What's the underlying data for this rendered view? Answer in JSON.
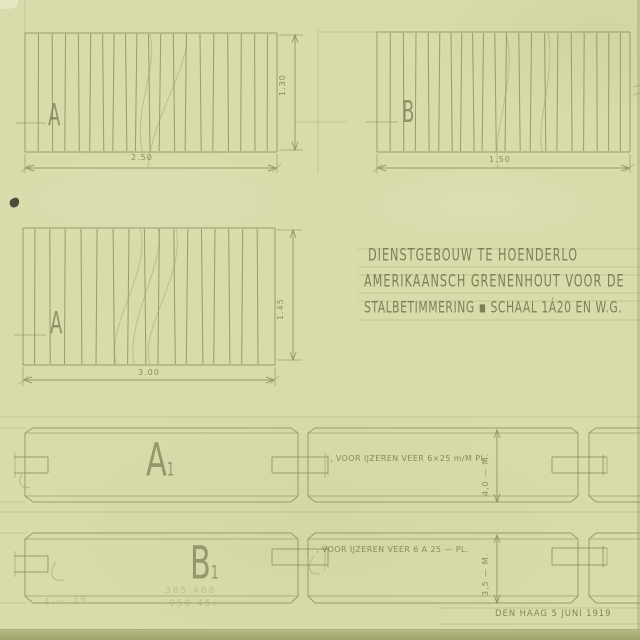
{
  "title_block": {
    "line1": "DIENSTGEBOUW TE HOENDERLO",
    "line2": "AMERIKAANSCH GRENENHOUT VOOR DE",
    "line3": "STALBETIMMERING ▪ SCHAAL 1Á20 EN W.G."
  },
  "panels": {
    "top_left": {
      "label": "A",
      "width_dim": "2.50",
      "height_dim": "1.30",
      "slat_count": 19
    },
    "top_right": {
      "label": "B",
      "width_dim": "1.50",
      "slat_count": 20
    },
    "mid_left": {
      "label": "A",
      "width_dim": "3.00",
      "height_dim": "1.45",
      "slat_count": 16
    }
  },
  "plank_rows": {
    "row_a": {
      "label": "A",
      "index": "1",
      "note": ", VOOR IJZEREN VEER 6×25 m/M PL.",
      "thickness_dim": "4,0 — M."
    },
    "row_b": {
      "label": "B",
      "index": "1",
      "note": ", VOOR IJZEREN VEER 6 A 25 — PL.",
      "thickness_dim": "3,5 — M."
    }
  },
  "footer": {
    "place_date": "DEN HAAG 5 JUNI 1919"
  },
  "pencil_scribbles": {
    "s1": "4·—  39",
    "s2": "385  468",
    "s3": "950  45c"
  },
  "colors": {
    "paper": "#d8dcaa",
    "ink_line": "#8c8a5a",
    "lettering": "#76744c",
    "pencil": "#9a9a72",
    "ink_blot": "#3c3d2e",
    "paper_edge": "#a8ae7a"
  }
}
